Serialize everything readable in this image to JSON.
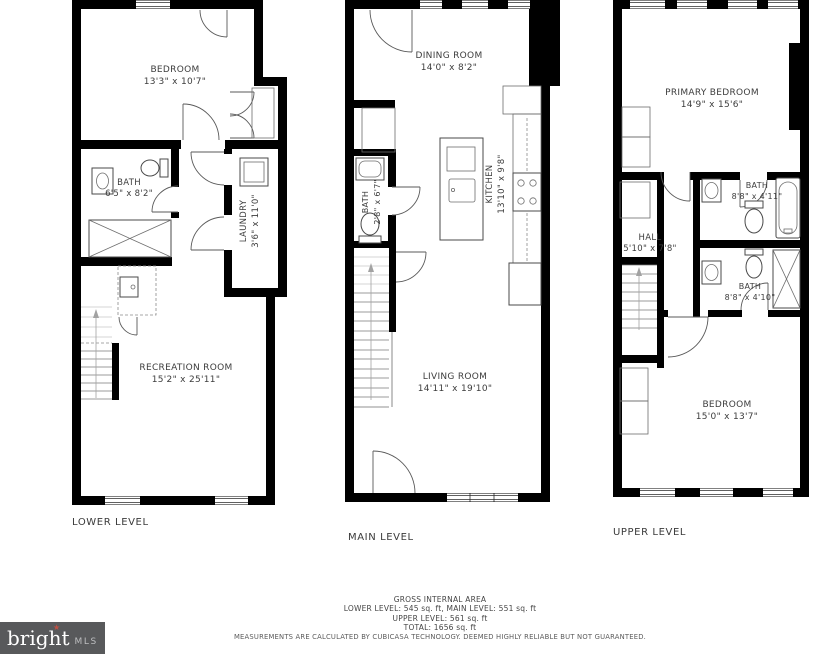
{
  "branding": {
    "logo_text": "bright",
    "logo_mark": "★",
    "logo_suffix": "MLS",
    "logo_bg": "#58595b",
    "logo_star_color": "#c05043"
  },
  "colors": {
    "wall": "#000000",
    "paper": "#ffffff",
    "label_text": "#3d3d3d"
  },
  "levels": {
    "lower": {
      "label": "LOWER LEVEL",
      "rooms": {
        "bedroom": {
          "name": "BEDROOM",
          "dims": "13'3\" x 10'7\""
        },
        "bath": {
          "name": "BATH",
          "dims": "6'5\" x 8'2\""
        },
        "laundry": {
          "name": "LAUNDRY",
          "dims": "3'6\" x 11'0\""
        },
        "recreation": {
          "name": "RECREATION ROOM",
          "dims": "15'2\" x 25'11\""
        }
      }
    },
    "main": {
      "label": "MAIN LEVEL",
      "rooms": {
        "dining": {
          "name": "DINING ROOM",
          "dims": "14'0\" x 8'2\""
        },
        "bath": {
          "name": "BATH",
          "dims": "2'8\" x 6'7\""
        },
        "kitchen": {
          "name": "KITCHEN",
          "dims": "13'10\" x 9'8\""
        },
        "living": {
          "name": "LIVING ROOM",
          "dims": "14'11\" x 19'10\""
        }
      }
    },
    "upper": {
      "label": "UPPER LEVEL",
      "rooms": {
        "primary": {
          "name": "PRIMARY BEDROOM",
          "dims": "14'9\" x 15'6\""
        },
        "bath1": {
          "name": "BATH",
          "dims": "8'8\" x 4'11\""
        },
        "hall": {
          "name": "HALL",
          "dims": "5'10\" x 7'8\""
        },
        "bath2": {
          "name": "BATH",
          "dims": "8'8\" x 4'10\""
        },
        "bedroom": {
          "name": "BEDROOM",
          "dims": "15'0\" x 13'7\""
        }
      }
    }
  },
  "footer": {
    "title": "GROSS INTERNAL AREA",
    "line1": "LOWER LEVEL: 545 sq. ft, MAIN LEVEL: 551 sq. ft",
    "line2": "UPPER LEVEL: 561 sq. ft",
    "line3": "TOTAL: 1656 sq. ft",
    "disclaimer": "MEASUREMENTS ARE CALCULATED BY CUBICASA TECHNOLOGY. DEEMED HIGHLY RELIABLE BUT NOT GUARANTEED."
  }
}
